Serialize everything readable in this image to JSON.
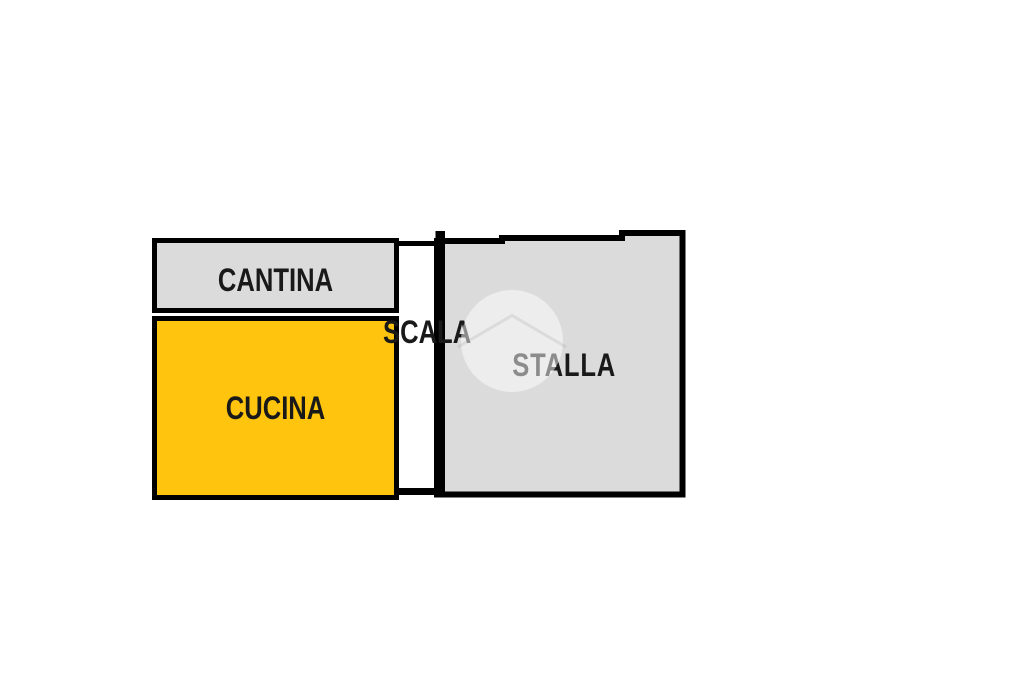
{
  "page": {
    "type": "floor-plan-drawing",
    "background": "#FFFFFF"
  },
  "floor_plan": {
    "rooms": [
      {
        "name": "cantina",
        "label": "CANTINA",
        "fill": "#DBDBDB"
      },
      {
        "name": "cucina",
        "label": "CUCINA",
        "fill": "#FFC40D"
      },
      {
        "name": "scala",
        "label": "SCALA",
        "fill": "#FFFFFF"
      },
      {
        "name": "stalla",
        "label": "STALLA",
        "fill": "#DBDBDB"
      }
    ],
    "wall_color": "#000000",
    "label_color": "#191919",
    "watermark_icon": "house-in-circle-watermark"
  }
}
